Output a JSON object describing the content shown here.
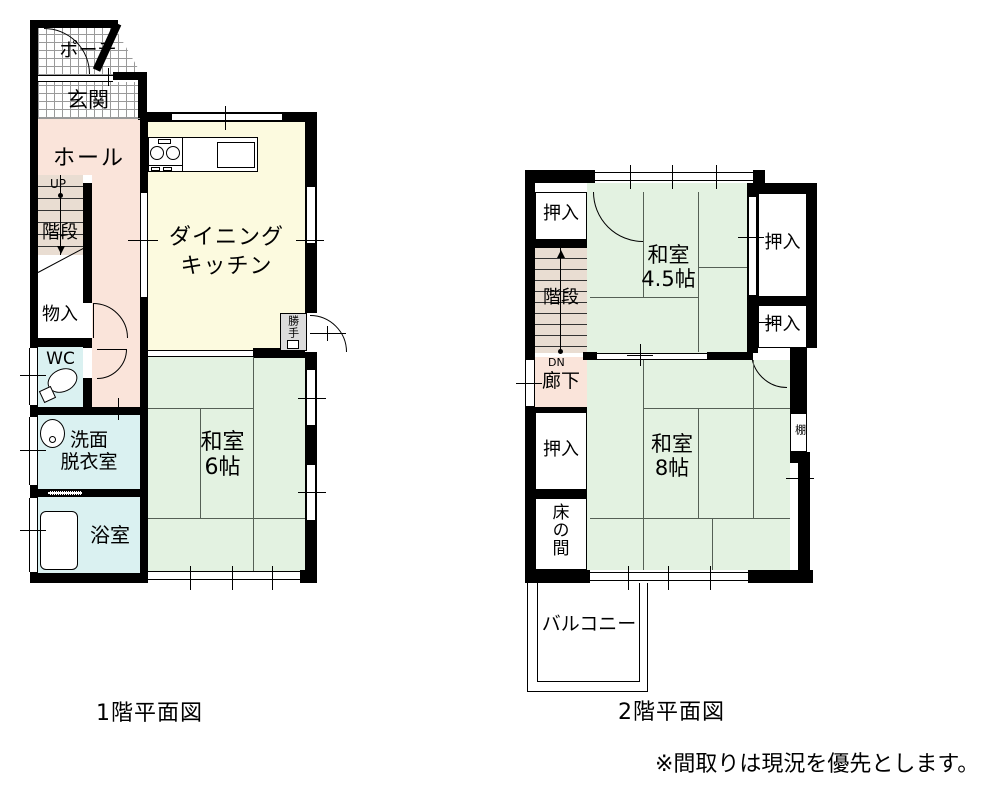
{
  "floor1": {
    "caption": "1階平面図",
    "porch": "ポーチ",
    "genkan": "玄関",
    "hall": "ホール",
    "up": "UP",
    "stairs": "階段",
    "storage": "物入",
    "wc": "WC",
    "washroom_line1": "洗面",
    "washroom_line2": "脱衣室",
    "bath": "浴室",
    "dk_line1": "ダイニング",
    "dk_line2": "キッチン",
    "katte": "勝手",
    "washitsu6_line1": "和室",
    "washitsu6_line2": "6帖"
  },
  "floor2": {
    "caption": "2階平面図",
    "closet": "押入",
    "stairs": "階段",
    "dn": "DN",
    "hallway": "廊下",
    "tokonoma": "床の間",
    "washitsu45_line1": "和室",
    "washitsu45_line2": "4.5帖",
    "washitsu8_line1": "和室",
    "washitsu8_line2": "8帖",
    "shelf": "棚",
    "balcony": "バルコニー"
  },
  "note": "※間取りは現況を優先とします。",
  "colors": {
    "wall": "#000000",
    "tatami_green": "#e3f2e1",
    "dk_yellow": "#fcfadf",
    "hall_pink": "#fae4da",
    "wet_cyan": "#daf1f1",
    "stairs_tan": "#e9ddd2",
    "katte_gray": "#dcdcdc"
  }
}
